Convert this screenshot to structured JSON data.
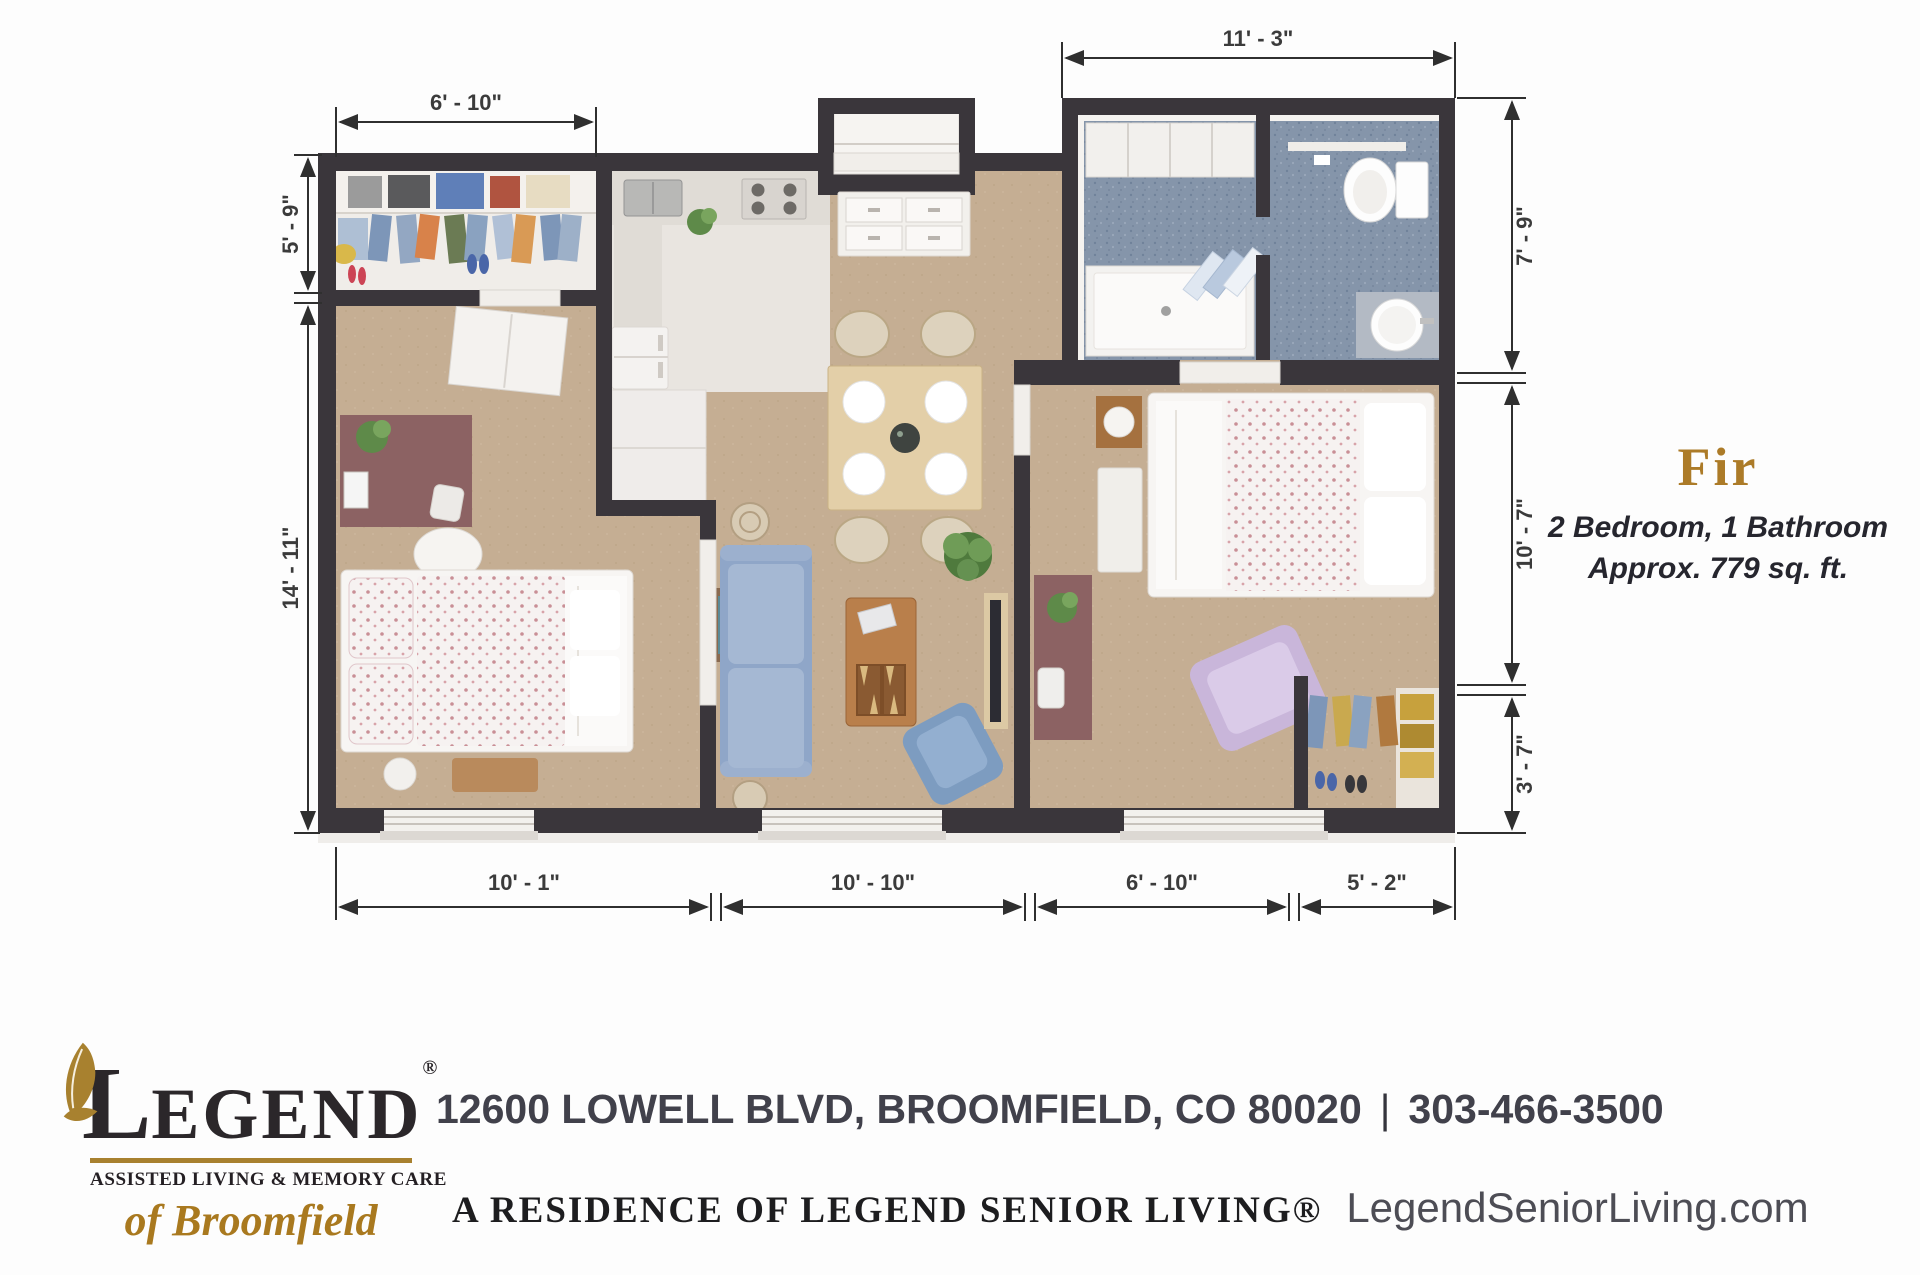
{
  "floor_plan": {
    "unit_name": "Fir",
    "unit_specs": "2 Bedroom, 1 Bathroom",
    "unit_area": "Approx. 779 sq. ft.",
    "dimensions": {
      "closet_width": "6' - 10\"",
      "bathroom_width": "11' - 3\"",
      "closet_depth": "5' - 9\"",
      "bedroom1_depth": "14' - 11\"",
      "bathroom_depth": "7' - 9\"",
      "bedroom2_depth": "10' - 7\"",
      "closet2_depth": "3' - 7\"",
      "bedroom1_width": "10' - 1\"",
      "living_width": "10' - 10\"",
      "bedroom2_width": "6' - 10\"",
      "closet2_width": "5' - 2\""
    },
    "colors": {
      "wall": "#3a363b",
      "floor_main": "#c5ae93",
      "floor_bathroom": "#8595aa",
      "accent_gold": "#ac7b28"
    }
  },
  "footer": {
    "logo": {
      "initial": "L",
      "rest": "EGEND",
      "registered": "®",
      "tagline": "ASSISTED LIVING & MEMORY CARE",
      "location": "of Broomfield"
    },
    "address": "12600 LOWELL BLVD, BROOMFIELD, CO 80020",
    "separator": "|",
    "phone": "303-466-3500",
    "residence_line": "A RESIDENCE OF LEGEND SENIOR LIVING®",
    "website": "LegendSeniorLiving.com"
  }
}
